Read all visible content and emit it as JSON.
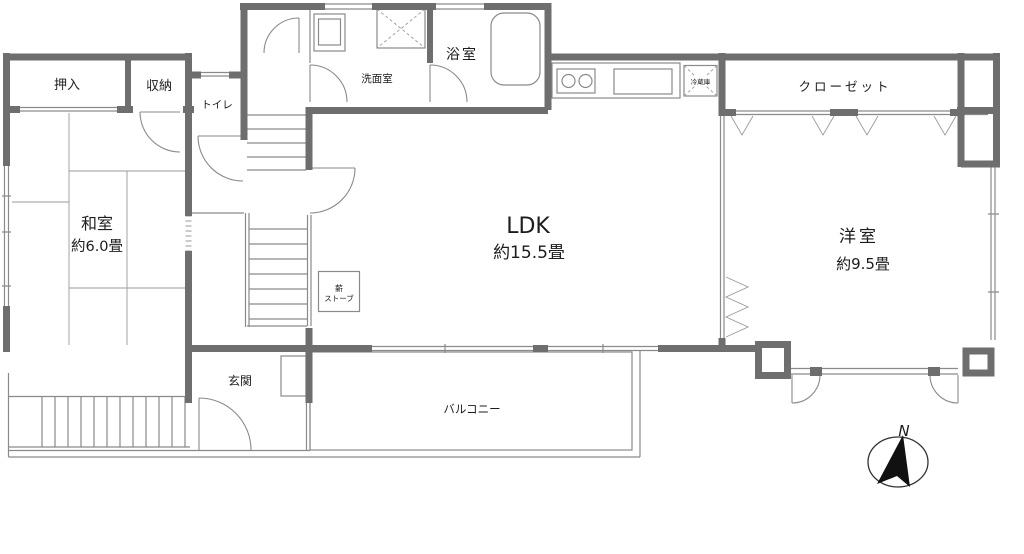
{
  "plan": {
    "rooms": {
      "oshiire": {
        "label": "押入"
      },
      "shuno": {
        "label": "収納"
      },
      "toilet": {
        "label": "トイレ"
      },
      "washroom": {
        "label": "洗面室"
      },
      "bath": {
        "label": "浴室"
      },
      "washitsu": {
        "label": "和室",
        "size": "約6.0畳"
      },
      "ldk": {
        "label": "LDK",
        "size": "約15.5畳"
      },
      "yoshitsu": {
        "label": "洋室",
        "size": "約9.5畳"
      },
      "closet": {
        "label": "クローゼット"
      },
      "genkan": {
        "label": "玄関"
      },
      "balcony": {
        "label": "バルコニー"
      }
    },
    "fixtures": {
      "wood_stove": {
        "label_line1": "薪",
        "label_line2": "ストーブ"
      },
      "refrigerator": {
        "label": "冷蔵庫"
      }
    },
    "compass": {
      "label": "N"
    },
    "colors": {
      "wall": "#6e6e6e",
      "line": "#8a8a8a",
      "text": "#1c1c1c"
    }
  }
}
